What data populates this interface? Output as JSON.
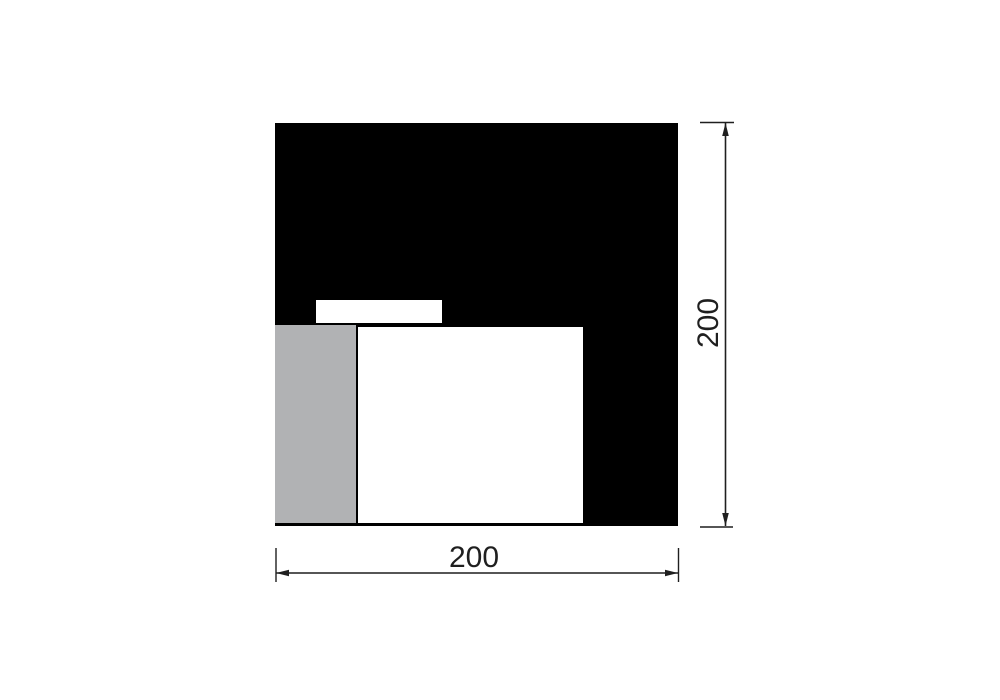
{
  "dimensions": {
    "width": {
      "label": "200"
    },
    "height": {
      "label": "200"
    }
  },
  "colors": {
    "line": "#1f1f1f",
    "black_fill": "#000000",
    "gray_fill": "#b1b2b4",
    "white_fill": "#ffffff",
    "background": "#ffffff"
  },
  "shapes": [
    {
      "name": "outer-square",
      "fill": "black"
    },
    {
      "name": "white-slot",
      "fill": "white"
    },
    {
      "name": "gray-rectangle",
      "fill": "gray"
    },
    {
      "name": "white-rectangle",
      "fill": "white"
    }
  ]
}
